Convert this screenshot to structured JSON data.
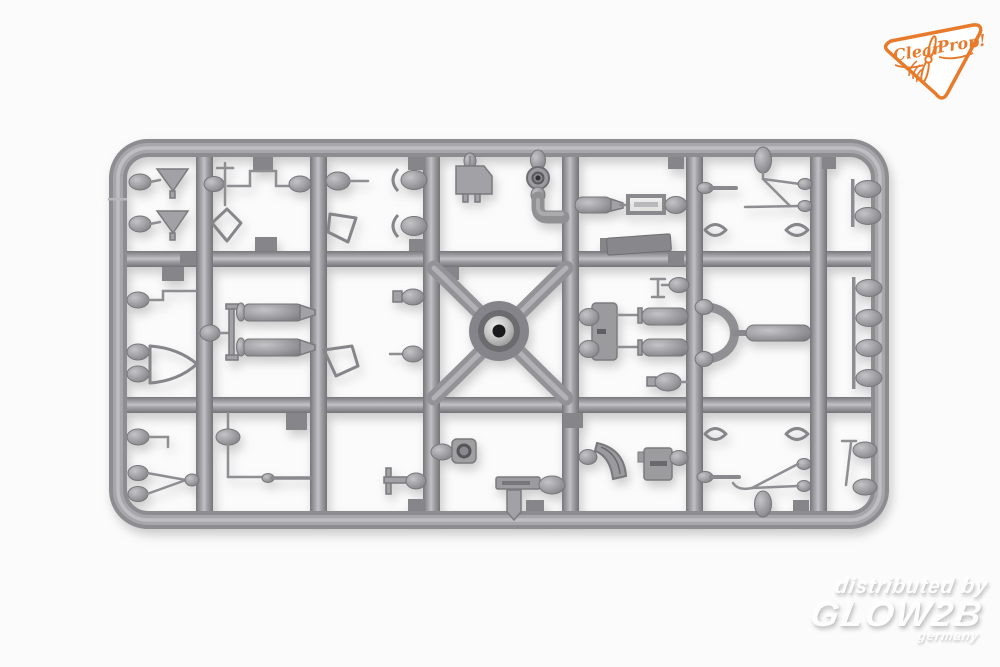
{
  "photo": {
    "subject": "Injection-molded gray styrene model kit sprue with small aircraft detail parts",
    "background_color": "#fbfbfb",
    "plastic_color": "#97979b",
    "plastic_highlight": "#c2c2c5",
    "plastic_shadow": "#747478",
    "hub_hole_color": "#1a1a1c"
  },
  "brand_badge": {
    "maker": "Clear Prop!",
    "word1": "Clear",
    "word2": "Prop!",
    "accent_color": "#e87a2b"
  },
  "watermark": {
    "line1": "distributed by",
    "line2": "GLOW2B",
    "line3": "germany",
    "text_color": "#fdfdfd"
  },
  "parts_inventory": [
    "funnel-cone x2",
    "fuel-line-with-post",
    "kite-frame",
    "float-with-fishtail x2",
    "bullet-with-pin x2",
    "shield-frame x2",
    "instrument-plate",
    "wheel-with-intake-elbow",
    "fuel-tank-with-mount-frame",
    "flat-plate",
    "rod-with-tip x2",
    "antenna-mast x2",
    "lens-frame x4",
    "pod-rack-2",
    "pod-rack-4",
    "pitot-tube x3",
    "canopy-frame",
    "drop-tank x2",
    "tank-bracket",
    "radiator-with-cylinders",
    "bullet-pod x6",
    "valve-tee",
    "horseshoe-intake",
    "bomb-with-lug",
    "wishbone-strut",
    "needle-rod",
    "tee-bracket",
    "lamp-housing",
    "bar-with-post",
    "cooling-fan-segment",
    "slotted-bracket",
    "diagonal-strut",
    "sprue-injection-hub"
  ]
}
